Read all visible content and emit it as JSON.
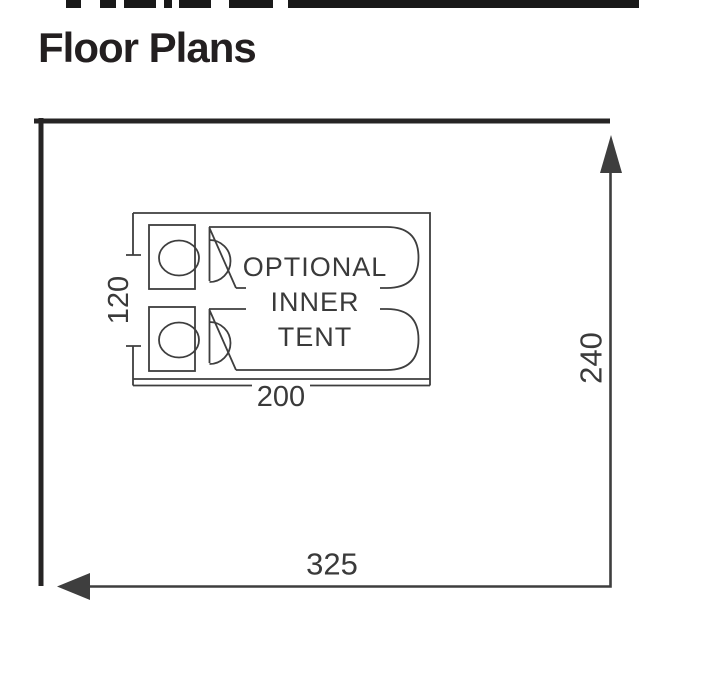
{
  "page": {
    "title": "Floor Plans"
  },
  "diagram": {
    "outer_width_label": "325",
    "outer_height_label": "240",
    "inner_width_label": "200",
    "inner_height_label": "120",
    "inner_tent_label": [
      "OPTIONAL",
      "INNER",
      "TENT"
    ],
    "colors": {
      "wall": "#262424",
      "line": "#3e3e3e",
      "text": "#3a3a3a",
      "title_text": "#231f20",
      "top_bar": "#191919"
    }
  }
}
